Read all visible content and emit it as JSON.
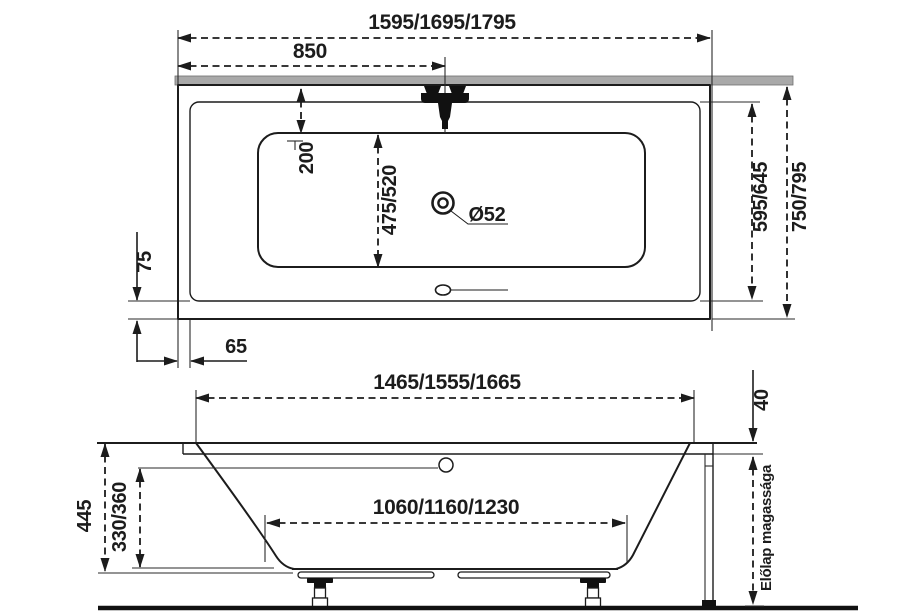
{
  "drawing": {
    "kind": "bathtub-technical-drawing",
    "colors": {
      "wall_gray": "#a9a9a9",
      "line_black": "#1c1c1c"
    },
    "top_view": {
      "overall_length": "1595/1695/1795",
      "faucet_offset": "850",
      "rim_to_basin": "200",
      "basin_width": "475/520",
      "inner_width": "595/645",
      "overall_width": "750/795",
      "bottom_rim_width": "75",
      "side_rim_width": "65",
      "drain_diameter": "Ø52"
    },
    "side_view": {
      "under_rim_length": "1465/1555/1665",
      "rim_height": "40",
      "total_depth": "445",
      "inner_depth": "330/360",
      "base_length": "1060/1160/1230",
      "panel_height_label": "Előlap magassága"
    }
  }
}
